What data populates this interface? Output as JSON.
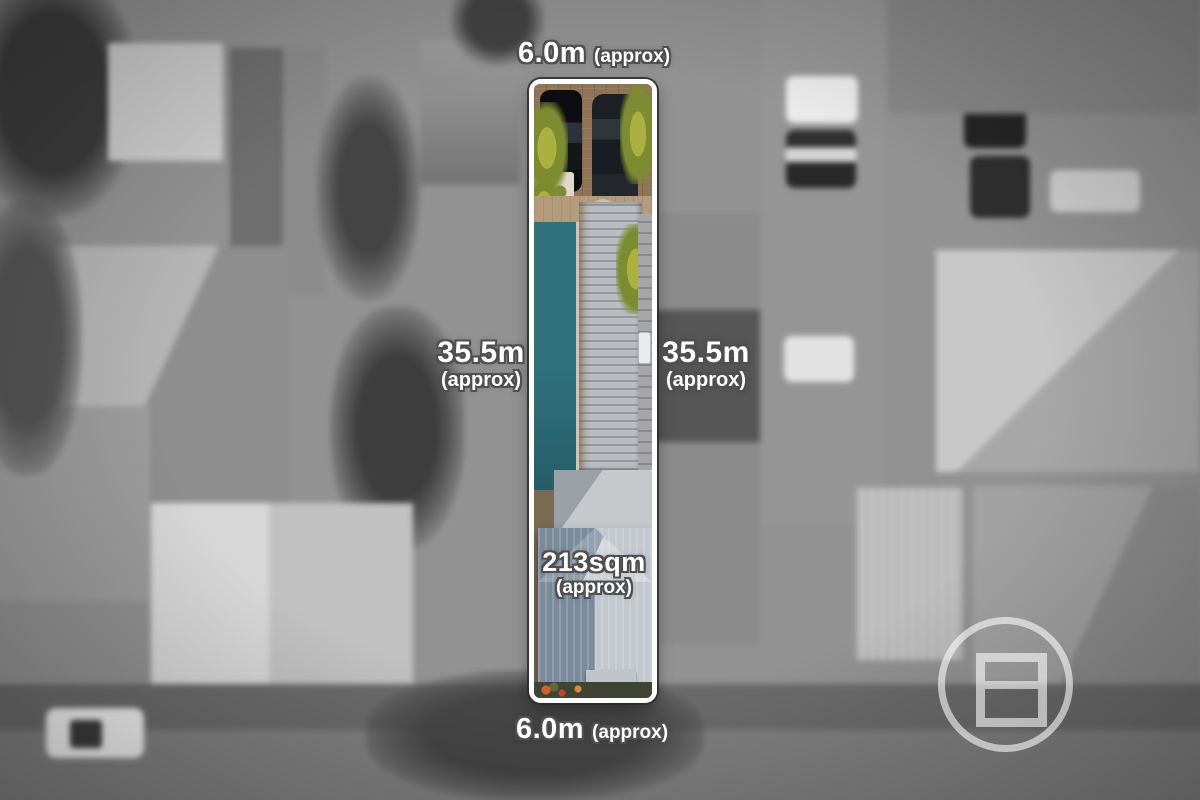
{
  "scene": {
    "description": "Grayscale blurred aerial photo of a residential block with one long narrow property highlighted in colour and outlined in white"
  },
  "labels": {
    "top": {
      "value": "6.0m",
      "qualifier": "(approx)"
    },
    "bottom": {
      "value": "6.0m",
      "qualifier": "(approx)"
    },
    "left": {
      "value": "35.5m",
      "qualifier": "(approx)"
    },
    "right": {
      "value": "35.5m",
      "qualifier": "(approx)"
    },
    "area": {
      "value": "213sqm",
      "qualifier": "(approx)"
    }
  },
  "watermark": {
    "icon": "circle-with-stacked-squares-logo",
    "opacity": 0.58,
    "color": "#FFFFFF"
  },
  "colors": {
    "boundary_outline": "#FFFFFF",
    "boundary_inner_line": "#2A2A2A",
    "label_text": "#FFFFFF",
    "label_outline": "#4F4F4F",
    "pool": "#30717C",
    "main_roof": "#8494A3",
    "flat_roof": "#B9BCC0",
    "driveway": "#8F7457",
    "plants": "#7E8C31",
    "background_gray": "#939393"
  }
}
